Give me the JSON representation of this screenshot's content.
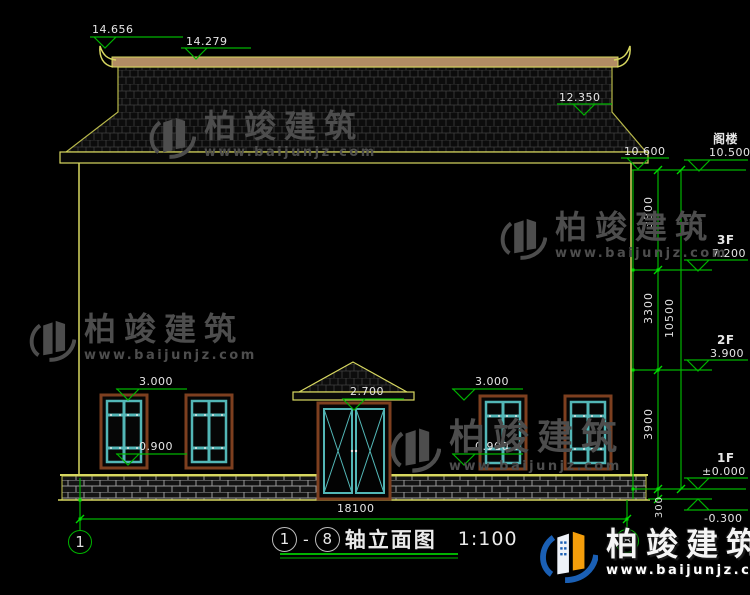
{
  "brand": {
    "name": "柏竣建筑",
    "url": "www.baijunjz.com"
  },
  "drawing": {
    "title_axis_start": "1",
    "title_axis_end": "8",
    "title_text": "轴立面图",
    "title_scale": "1:100"
  },
  "axes": {
    "left": "1",
    "right": "8"
  },
  "elevations": {
    "ridge_tip": "14.656",
    "ridge": "14.279",
    "roof_slope": "12.350",
    "eave": "10.600",
    "attic_label": "阁楼",
    "attic": "10.500",
    "f3_label": "3F",
    "f3": "7.200",
    "f2_label": "2F",
    "f2": "3.900",
    "f1_label": "1F",
    "f1": "±0.000",
    "ground": "-0.300",
    "window_top": "3.000",
    "window_sill": "0.900",
    "door_top": "2.700"
  },
  "dimensions": {
    "total_width": "18100",
    "attic_to_f3": "3300",
    "f3_to_f2": "3300",
    "f2_to_f1": "3900",
    "total_height": "10500",
    "plinth_height": "300"
  },
  "colors": {
    "dim_green": "#00b400",
    "cad_yellow": "#d6d65a",
    "frame_cyan": "#53b7b7",
    "frame_brown": "#7d3f1f",
    "ridge_tan": "#b28c64",
    "brand_blue": "#1a5fb4",
    "brand_orange": "#f59e0b"
  }
}
